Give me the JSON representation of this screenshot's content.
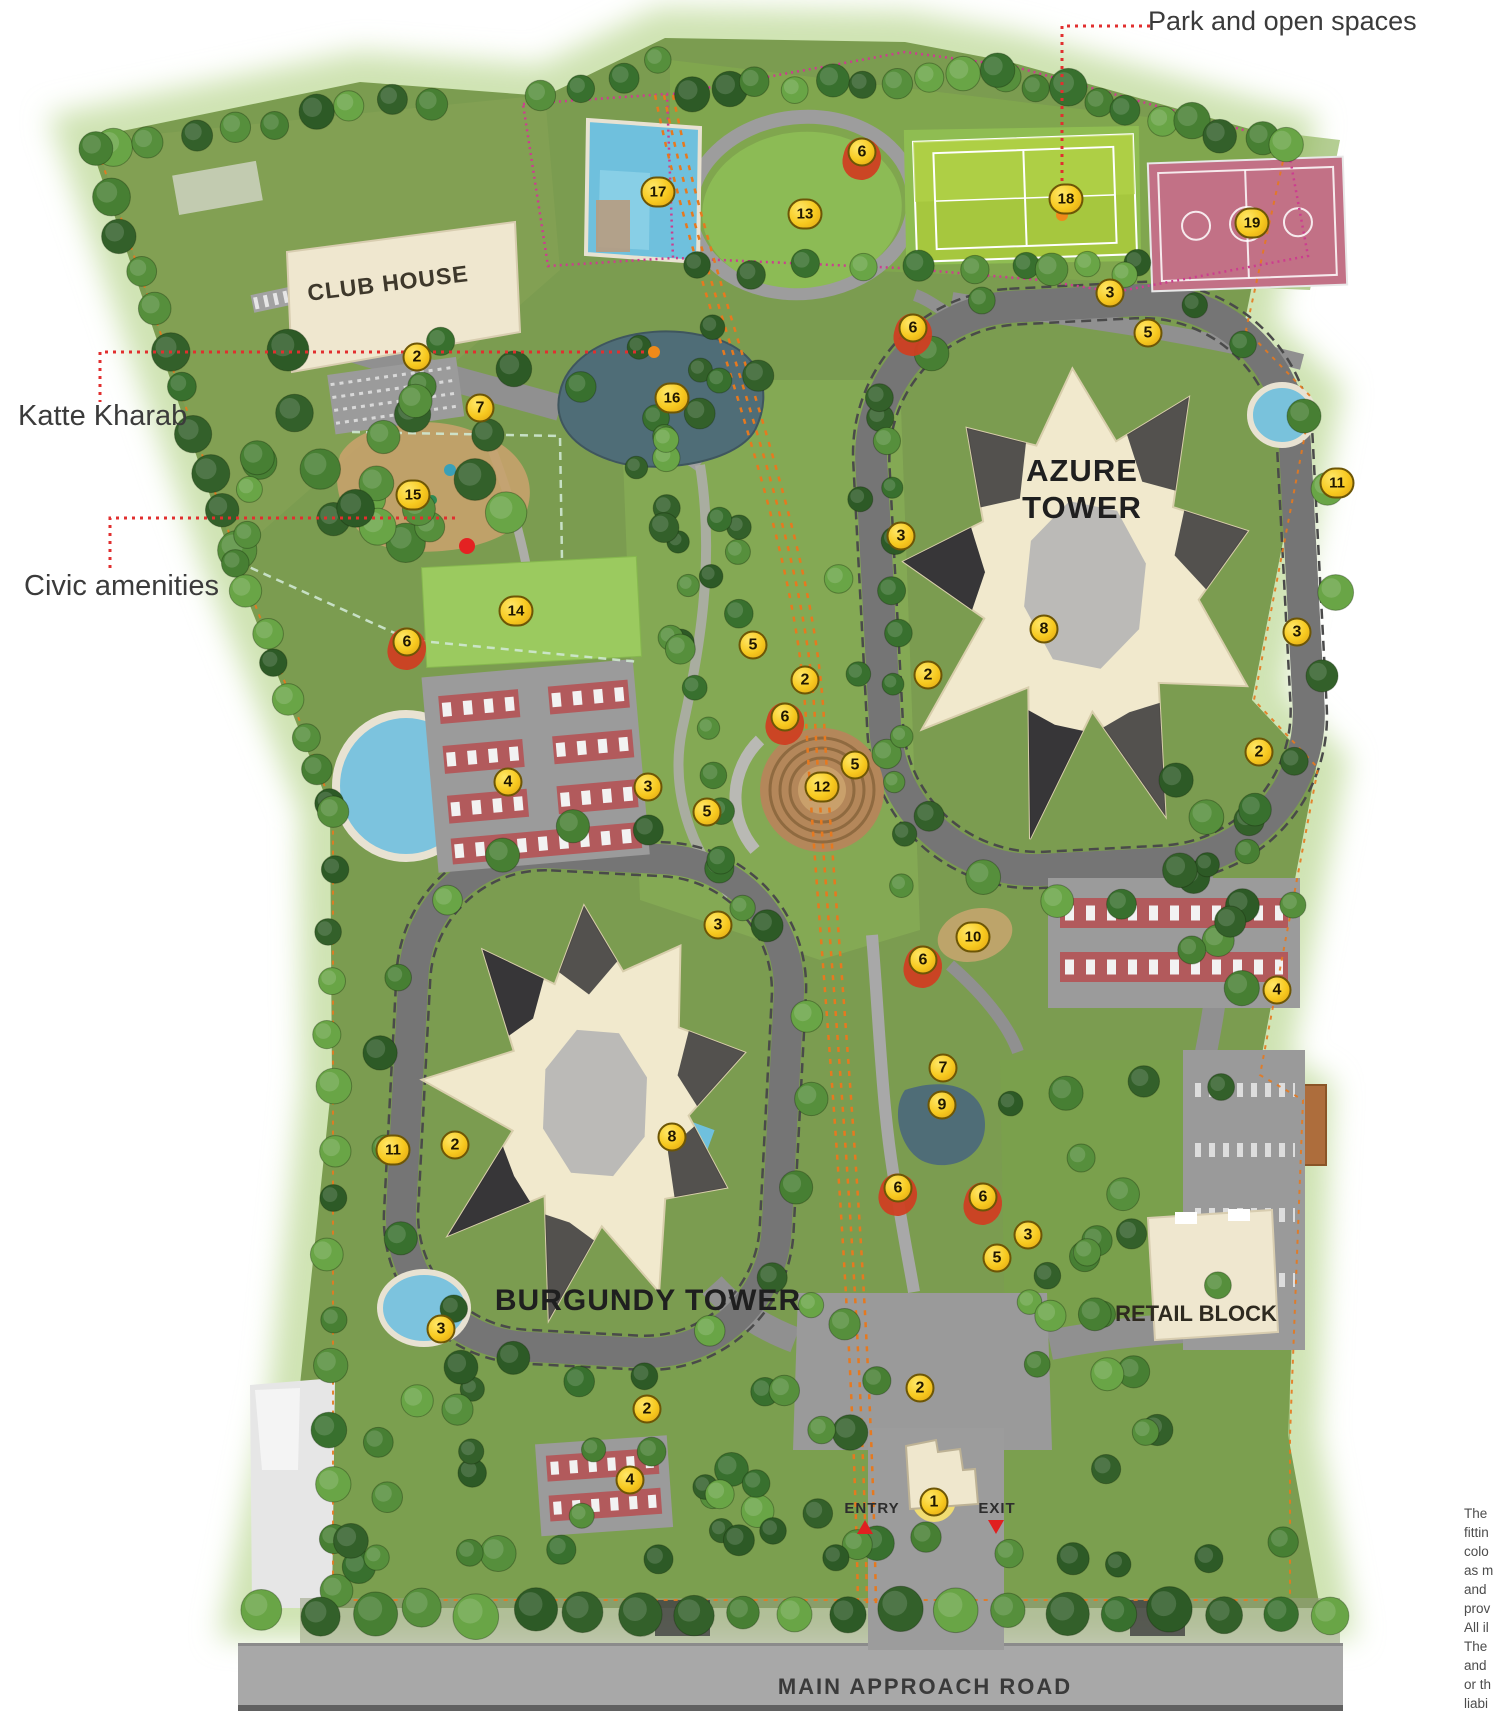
{
  "annotations": {
    "park": {
      "label": "Park and open spaces"
    },
    "katte": {
      "label": "Katte Kharab"
    },
    "civic": {
      "label": "Civic amenities"
    }
  },
  "places": {
    "club_house": "CLUB HOUSE",
    "azure_tower": "AZURE TOWER",
    "burgundy_tower": "BURGUNDY TOWER",
    "retail_block": "RETAIL BLOCK",
    "main_road": "MAIN APPROACH ROAD",
    "entry": "ENTRY",
    "exit": "EXIT"
  },
  "markers": [
    {
      "n": "17",
      "x": 658,
      "y": 192
    },
    {
      "n": "6",
      "x": 862,
      "y": 152,
      "red": true
    },
    {
      "n": "13",
      "x": 805,
      "y": 214
    },
    {
      "n": "18",
      "x": 1066,
      "y": 199
    },
    {
      "n": "19",
      "x": 1252,
      "y": 223
    },
    {
      "n": "3",
      "x": 1110,
      "y": 293
    },
    {
      "n": "6",
      "x": 913,
      "y": 328,
      "red": true
    },
    {
      "n": "5",
      "x": 1148,
      "y": 333
    },
    {
      "n": "2",
      "x": 417,
      "y": 357
    },
    {
      "n": "16",
      "x": 672,
      "y": 398
    },
    {
      "n": "7",
      "x": 480,
      "y": 408
    },
    {
      "n": "11",
      "x": 1337,
      "y": 483
    },
    {
      "n": "15",
      "x": 413,
      "y": 495
    },
    {
      "n": "3",
      "x": 901,
      "y": 536
    },
    {
      "n": "14",
      "x": 516,
      "y": 611
    },
    {
      "n": "8",
      "x": 1044,
      "y": 629
    },
    {
      "n": "3",
      "x": 1297,
      "y": 632
    },
    {
      "n": "6",
      "x": 407,
      "y": 642,
      "red": true
    },
    {
      "n": "5",
      "x": 753,
      "y": 645
    },
    {
      "n": "2",
      "x": 805,
      "y": 680
    },
    {
      "n": "2",
      "x": 928,
      "y": 675
    },
    {
      "n": "6",
      "x": 785,
      "y": 717,
      "red": true
    },
    {
      "n": "2",
      "x": 1259,
      "y": 752
    },
    {
      "n": "5",
      "x": 855,
      "y": 765
    },
    {
      "n": "4",
      "x": 508,
      "y": 782
    },
    {
      "n": "12",
      "x": 822,
      "y": 787
    },
    {
      "n": "3",
      "x": 648,
      "y": 787
    },
    {
      "n": "5",
      "x": 707,
      "y": 812
    },
    {
      "n": "3",
      "x": 718,
      "y": 925
    },
    {
      "n": "10",
      "x": 973,
      "y": 937
    },
    {
      "n": "6",
      "x": 923,
      "y": 960,
      "red": true
    },
    {
      "n": "4",
      "x": 1277,
      "y": 990
    },
    {
      "n": "7",
      "x": 943,
      "y": 1068
    },
    {
      "n": "9",
      "x": 942,
      "y": 1105
    },
    {
      "n": "8",
      "x": 672,
      "y": 1137
    },
    {
      "n": "2",
      "x": 455,
      "y": 1145
    },
    {
      "n": "11",
      "x": 393,
      "y": 1150
    },
    {
      "n": "6",
      "x": 898,
      "y": 1188,
      "red": true
    },
    {
      "n": "6",
      "x": 983,
      "y": 1197,
      "red": true
    },
    {
      "n": "3",
      "x": 1028,
      "y": 1235
    },
    {
      "n": "5",
      "x": 997,
      "y": 1258
    },
    {
      "n": "3",
      "x": 441,
      "y": 1329
    },
    {
      "n": "2",
      "x": 920,
      "y": 1388
    },
    {
      "n": "2",
      "x": 647,
      "y": 1409
    },
    {
      "n": "4",
      "x": 630,
      "y": 1480
    },
    {
      "n": "1",
      "x": 934,
      "y": 1502
    }
  ],
  "disclaimer": {
    "lines": [
      "The",
      "fittin",
      "colo",
      "as m",
      "and",
      "prov",
      "All il",
      "The",
      "and",
      "or th",
      "liabi"
    ]
  },
  "colors": {
    "terrain_green": "#7b9c50",
    "road_gray": "#909090",
    "building_cream": "#f1e9cd",
    "water_blue": "#7cc3de",
    "pond_dark": "#4f6d77",
    "tennis_court": "#a6c73e",
    "basketball_court": "#c27186",
    "parking_red": "#b25a5c",
    "marker_gold": "#f7c91f",
    "boundary_magenta": "#cc3d8f",
    "boundary_orange": "#e6791f",
    "leader_red": "#e12f2f"
  }
}
